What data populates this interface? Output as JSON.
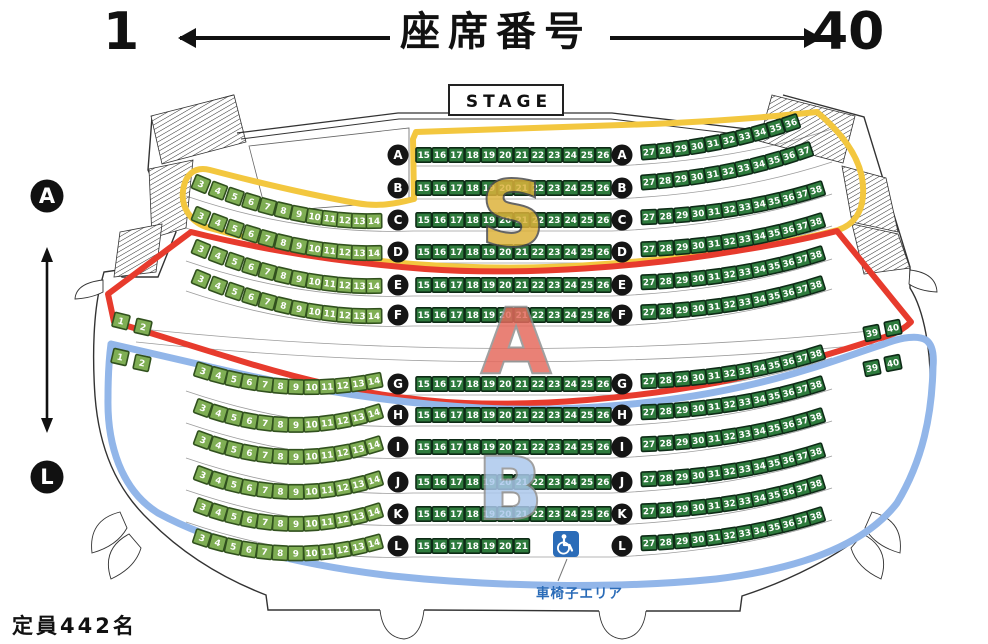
{
  "header": {
    "min_seat": "1",
    "max_seat": "40",
    "title": "座席番号"
  },
  "stage": {
    "label": "STAGE"
  },
  "row_axis": {
    "first_row": "A",
    "last_row": "L"
  },
  "capacity_label": "定員442名",
  "wheelchair": {
    "area_label": "車椅子エリア"
  },
  "sections": [
    {
      "id": "S",
      "letter": "S",
      "outline_color": "#f3c73f",
      "letter_fill": "#ddb23a",
      "letter_stroke": "#4a4a4a"
    },
    {
      "id": "A",
      "letter": "A",
      "outline_color": "#e73b2d",
      "letter_fill": "#e56a5d",
      "letter_stroke": "#8f8f8f"
    },
    {
      "id": "B",
      "letter": "B",
      "outline_color": "#92b6e9",
      "letter_fill": "#abc8ec",
      "letter_stroke": "#8f8f8f"
    }
  ],
  "seat_style": {
    "side_fill": "#7fae54",
    "side_border": "#31511e",
    "main_fill": "#2e7b3d",
    "main_border": "#0e2b17",
    "number_color": "#ffffff"
  },
  "rows": [
    {
      "label": "A",
      "center": {
        "start": 15,
        "end": 26
      },
      "right": {
        "start": 27,
        "end": 36
      }
    },
    {
      "label": "B",
      "center": {
        "start": 15,
        "end": 26
      },
      "right": {
        "start": 27,
        "end": 37
      }
    },
    {
      "label": "C",
      "left": {
        "start": 3,
        "end": 14
      },
      "center": {
        "start": 15,
        "end": 26
      },
      "right": {
        "start": 27,
        "end": 38
      }
    },
    {
      "label": "D",
      "left": {
        "start": 3,
        "end": 14
      },
      "center": {
        "start": 15,
        "end": 26
      },
      "right": {
        "start": 27,
        "end": 38
      }
    },
    {
      "label": "E",
      "left": {
        "start": 3,
        "end": 14
      },
      "center": {
        "start": 15,
        "end": 26
      },
      "right": {
        "start": 27,
        "end": 38
      }
    },
    {
      "label": "F",
      "far_left": {
        "start": 1,
        "end": 2
      },
      "left": {
        "start": 3,
        "end": 14
      },
      "center": {
        "start": 15,
        "end": 26
      },
      "right": {
        "start": 27,
        "end": 38
      },
      "far_right": {
        "start": 39,
        "end": 40
      }
    },
    {
      "label": "G",
      "far_left": {
        "start": 1,
        "end": 2
      },
      "left": {
        "start": 3,
        "end": 14
      },
      "center": {
        "start": 15,
        "end": 26
      },
      "right": {
        "start": 27,
        "end": 38
      },
      "far_right": {
        "start": 39,
        "end": 40
      }
    },
    {
      "label": "H",
      "left": {
        "start": 3,
        "end": 14
      },
      "center": {
        "start": 15,
        "end": 26
      },
      "right": {
        "start": 27,
        "end": 38
      }
    },
    {
      "label": "I",
      "left": {
        "start": 3,
        "end": 14
      },
      "center": {
        "start": 15,
        "end": 26
      },
      "right": {
        "start": 27,
        "end": 38
      }
    },
    {
      "label": "J",
      "left": {
        "start": 3,
        "end": 14
      },
      "center": {
        "start": 15,
        "end": 26
      },
      "right": {
        "start": 27,
        "end": 38
      }
    },
    {
      "label": "K",
      "left": {
        "start": 3,
        "end": 14
      },
      "center": {
        "start": 15,
        "end": 26
      },
      "right": {
        "start": 27,
        "end": 38
      }
    },
    {
      "label": "L",
      "left": {
        "start": 3,
        "end": 14
      },
      "center": {
        "start": 15,
        "end": 21
      },
      "right": {
        "start": 27,
        "end": 38
      }
    }
  ]
}
